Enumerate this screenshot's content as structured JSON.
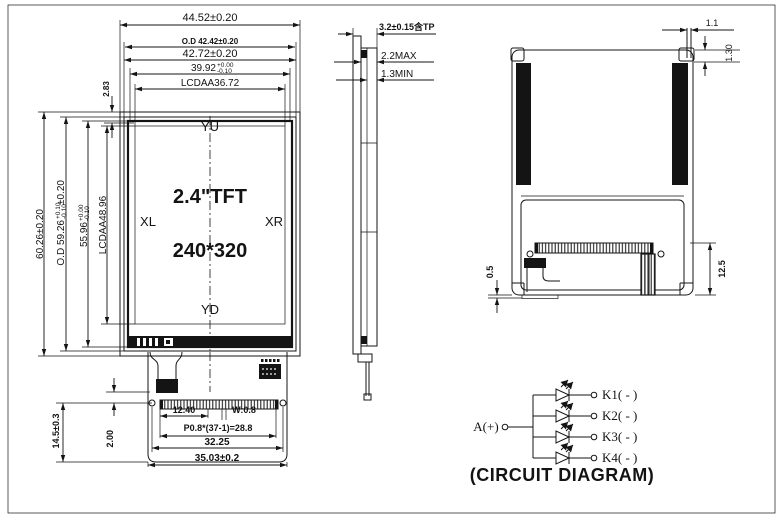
{
  "front_view": {
    "screen": {
      "top_label": "YU",
      "bottom_label": "YD",
      "left_label": "XL",
      "right_label": "XR",
      "size_label": "2.4\"TFT",
      "resolution_label": "240*320"
    },
    "dims_top": {
      "overall_width": "44.52±0.20",
      "outline_width": "O.D 42.42±0.20",
      "bezel_width": "42.72±0.20",
      "va_width": {
        "main": "39.92",
        "tol_plus": "+0.00",
        "tol_minus": "-0.10"
      },
      "aa_width": "LCDAA36.72",
      "edge_gap": "2.83"
    },
    "dims_left": {
      "overall_height": "60.26±0.20",
      "outline_height": {
        "main": "O.D 59.26",
        "tol_plus": "+0.10",
        "tol_minus": "-0.10",
        "suffix": "±0.20"
      },
      "va_height": {
        "main": "55.96",
        "tol_plus": "+0.00",
        "tol_minus": "-0.10"
      },
      "aa_height": "LCDAA48.96",
      "fpc_length": "14.5±0.3",
      "hole_offset": "2.00"
    },
    "dims_bottom": {
      "pin_start": "12.40",
      "pin_width": "W:0.8",
      "pin_pitch": "P0.8*(37-1)=28.8",
      "hole_span": "32.25",
      "fpc_width": "35.03±0.2"
    }
  },
  "side_view": {
    "total_thickness": "3.2±0.15含TP",
    "lcd_max": "2.2MAX",
    "lcd_min": "1.3MIN"
  },
  "rear_view": {
    "hook_width": "1.1",
    "hook_height": "1.30",
    "fpc_offset": "0.5",
    "bottom_section_height": "12.5"
  },
  "circuit": {
    "anode_label": "A(+)",
    "cathode_labels": [
      "K1( - )",
      "K2( - )",
      "K3( - )",
      "K4( - )"
    ],
    "caption": "(CIRCUIT DIAGRAM)"
  }
}
